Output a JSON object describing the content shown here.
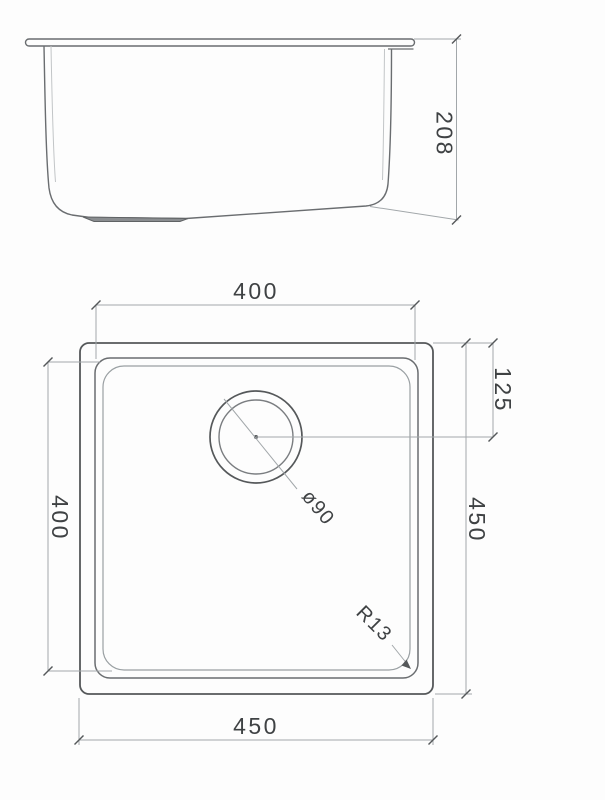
{
  "drawing": {
    "description": "Two-view technical dimension drawing of a square undermount kitchen sink",
    "colors": {
      "background": "#fdfdfd",
      "object_line": "#55585a",
      "dimension_line": "#a2a7aa",
      "text": "#3f4244"
    },
    "side_view": {
      "name": "side elevation",
      "depth_dim": "208"
    },
    "plan_view": {
      "name": "top plan",
      "bowl_width_dim": "400",
      "bowl_length_dim": "400",
      "overall_length_dim": "450",
      "overall_width_dim": "450",
      "drain_offset_dim": "125",
      "drain_diameter_dim": "ø90",
      "corner_radius_dim": "R13"
    }
  }
}
